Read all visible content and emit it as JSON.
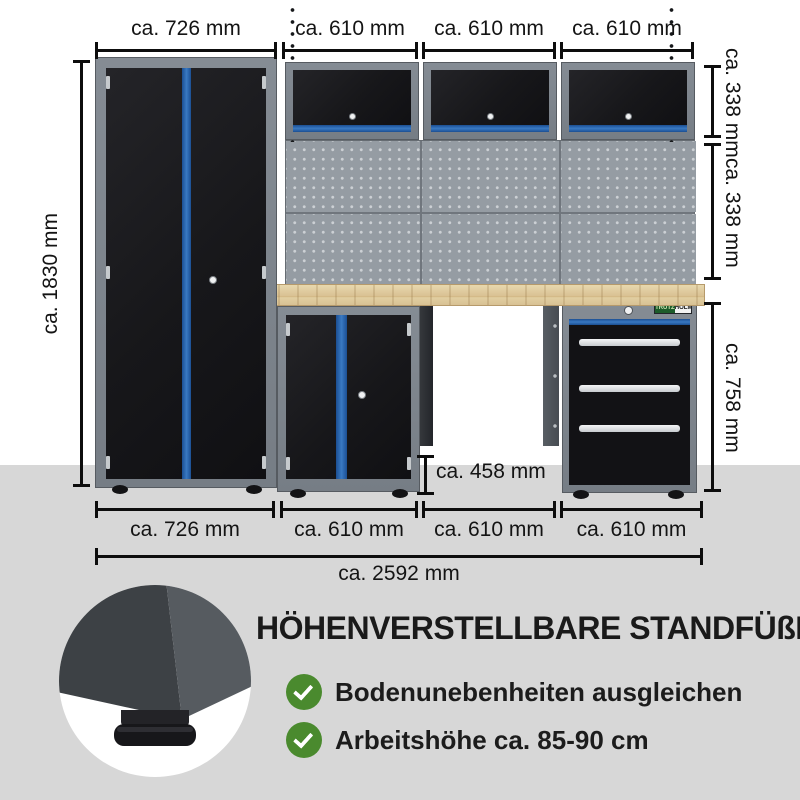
{
  "dims": {
    "top": [
      "ca. 726 mm",
      "ca. 610 mm",
      "ca. 610 mm",
      "ca. 610 mm"
    ],
    "left": "ca. 1830 mm",
    "right": [
      "ca. 338 mm",
      "ca. 338 mm",
      "ca. 758 mm"
    ],
    "middle": "ca. 458 mm",
    "bottom": [
      "ca. 726 mm",
      "ca. 610 mm",
      "ca. 610 mm",
      "ca. 610 mm"
    ],
    "total": "ca. 2592 mm"
  },
  "brand": {
    "left": "TRUTZ",
    "right": "HOLM"
  },
  "feature": {
    "title": "HÖHENVERSTELLBARE STANDFÜßE",
    "items": [
      {
        "label": "Bodenunebenheiten ausgleichen"
      },
      {
        "label": "Arbeitshöhe ca. 85-90 cm"
      }
    ]
  },
  "colors": {
    "accent_blue": "#2f6cb5",
    "check_green": "#4a8a2e",
    "floor_gray": "#d7d7d7",
    "frame_gray": "#7d848c",
    "door_black": "#17171a",
    "wood": "#d9c193"
  }
}
